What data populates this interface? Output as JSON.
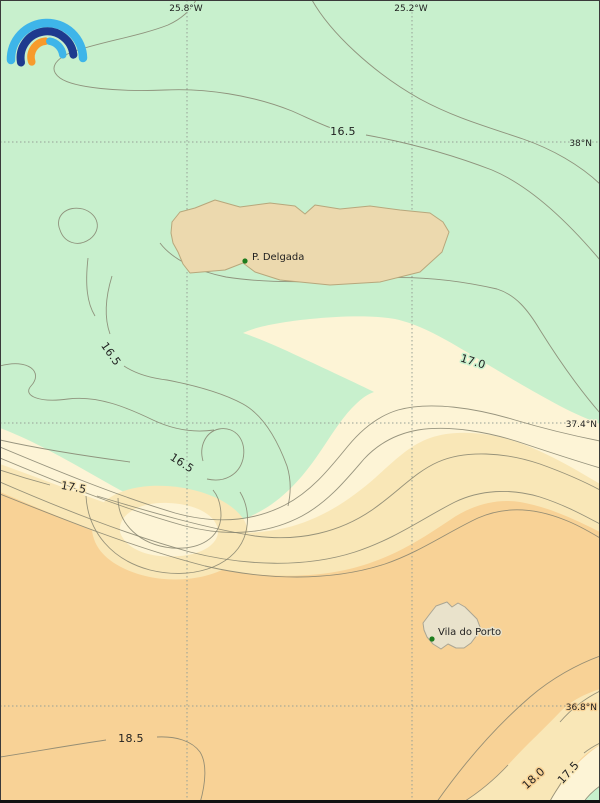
{
  "map": {
    "description": "Contour map of sea surface temperature around the Azores islands",
    "logo": {
      "name": "rainbow-arcs-logo",
      "arc_colors": [
        "#3eb5e9",
        "#1e3a8e",
        "#f79b2c",
        "#3eb5e9"
      ]
    },
    "graticule": {
      "longitude_labels": [
        {
          "text": "25.8°W"
        },
        {
          "text": "25.2°W"
        }
      ],
      "latitude_labels": [
        {
          "text": "38°N"
        },
        {
          "text": "37.4°N"
        },
        {
          "text": "36.8°N"
        }
      ]
    },
    "contours": {
      "labeled_levels": [
        "16.5",
        "17.0",
        "17.5",
        "18.0",
        "18.5"
      ],
      "labels": [
        {
          "text": "16.5"
        },
        {
          "text": "16.5"
        },
        {
          "text": "16.5"
        },
        {
          "text": "17.0"
        },
        {
          "text": "17.5"
        },
        {
          "text": "18.5"
        },
        {
          "text": "18.0"
        },
        {
          "text": "17.5"
        }
      ]
    },
    "places": [
      {
        "label": "P. Delgada"
      },
      {
        "label": "Vila do Porto"
      }
    ],
    "colors": {
      "sea_cool_green": "#c8f0cd",
      "band_lightest": "#fdf4d6",
      "band_cream": "#f9e7b7",
      "band_orange": "#f8d296",
      "island_sao_miguel": "#ecd9ae",
      "island_santa_maria": "#e9e2cb",
      "contour_line": "#85826e",
      "graticule": "#96a096",
      "place_marker": "#1e7d1e"
    }
  }
}
